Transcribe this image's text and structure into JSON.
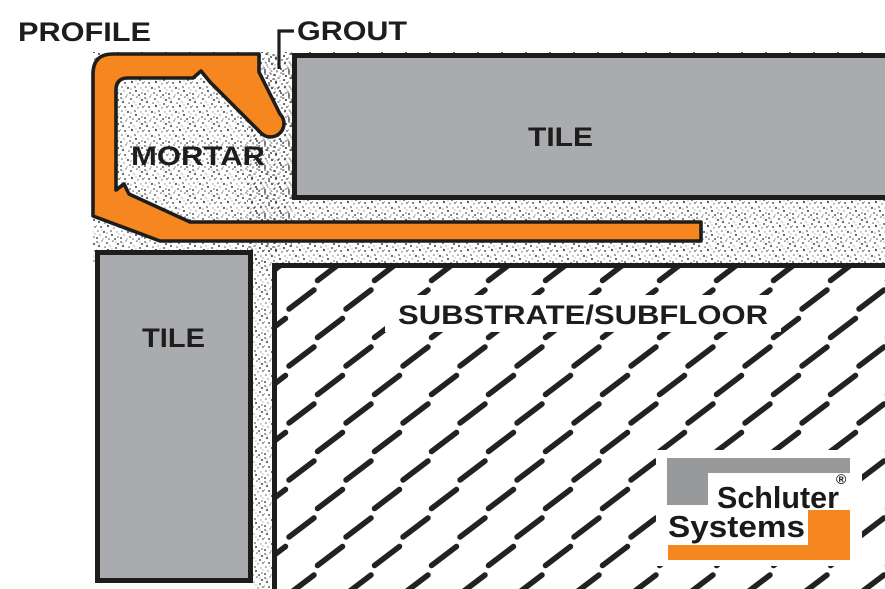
{
  "labels": {
    "profile": "PROFILE",
    "grout": "GROUT",
    "mortar": "MORTAR",
    "tile_top": "TILE",
    "tile_side": "TILE",
    "substrate": "SUBSTRATE/SUBFLOOR"
  },
  "logo": {
    "line1": "Schluter",
    "line2": "Systems",
    "registered": "®"
  },
  "colors": {
    "profile_orange": "#F6861F",
    "tile_gray": "#A9ABAE",
    "logo_gray": "#98999B",
    "outline_black": "#1D1D1B"
  }
}
